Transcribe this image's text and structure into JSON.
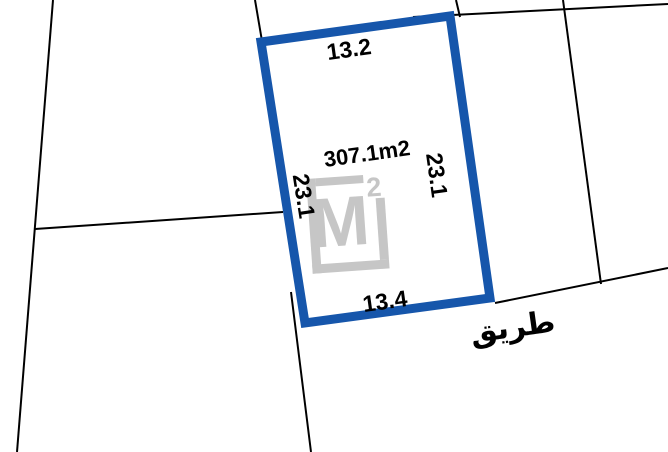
{
  "colors": {
    "plot_blue": "#1656ab",
    "boundary_black": "#000000",
    "watermark_gray": "#c6c6c6",
    "label_black": "#000000",
    "background": "#ffffff"
  },
  "plot": {
    "area_label": "307.1m2",
    "side_top": "13.2",
    "side_right": "23.1",
    "side_left": "23.1",
    "side_bottom": "13.4"
  },
  "road": {
    "label": "طريق"
  },
  "watermark": {
    "letter": "M",
    "superscript": "2"
  },
  "geometry": {
    "plot_outline_points": "261,42 450,16 490,298 305,323",
    "boundary_left": "M53,0 L17,452",
    "boundary_cross": "M35,229 L283,212",
    "boundary_top_left_stub": "M255,0 L262,41",
    "boundary_top_right": "M413,17 L668,4",
    "boundary_top_tick": "M456,0 L460,17",
    "boundary_right": "M563,0 L601,284",
    "road_line": "M495,303 L668,268",
    "boundary_below_plot": "M291,292 L311,452"
  }
}
